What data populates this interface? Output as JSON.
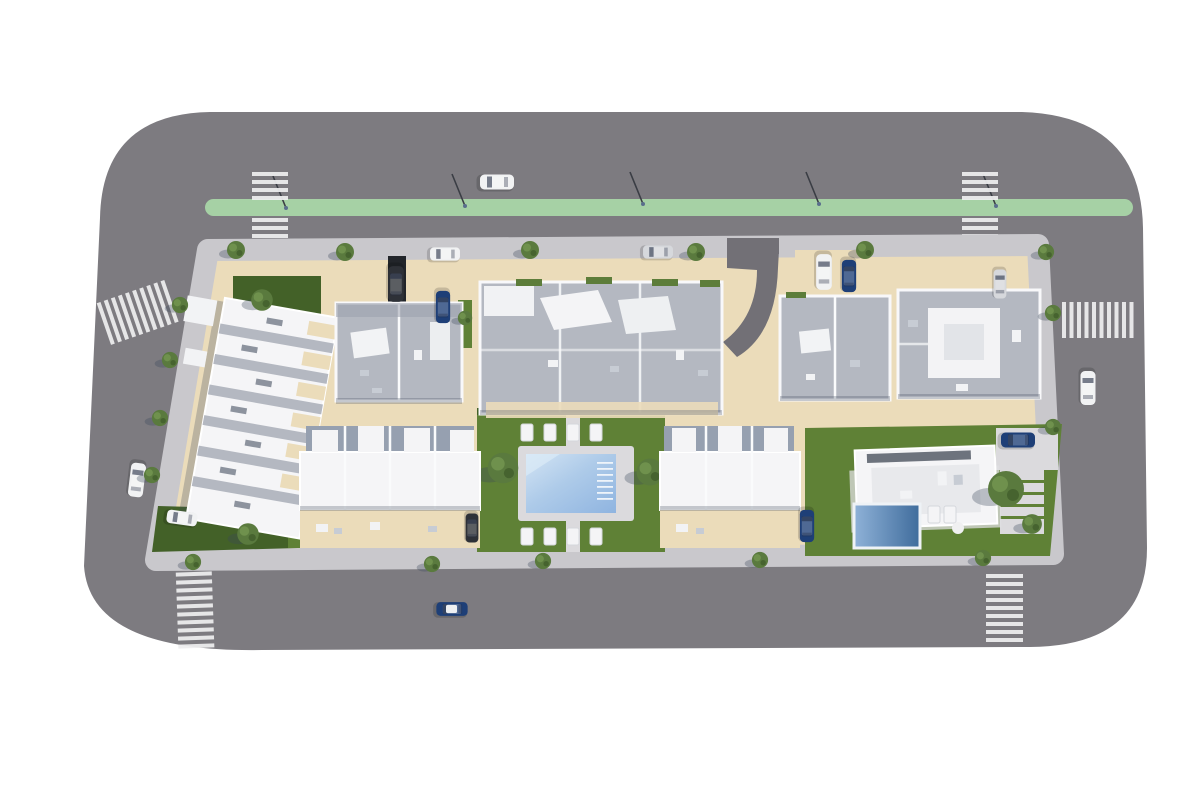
{
  "scene": {
    "kind": "aerial-architectural-render",
    "subject": "top-down 3D render of a residential development block surrounded by a perimeter road"
  },
  "colors": {
    "background": "#ffffff",
    "road": "#7d7b80",
    "roadDark": "#727076",
    "sidewalk": "#c9c8cc",
    "ground": "#ebdcba",
    "bikeLane": "#a6d1a5",
    "lawn": "#5f8136",
    "lawnDark": "#436128",
    "roofWhite": "#f5f5f7",
    "roofGray": "#b4b8c1",
    "roofGrayDark": "#9ba1ad",
    "court": "#96a0b0",
    "poolDeck": "#dbdadd",
    "poolWater": "#a9c9e8",
    "poolWaterLight": "#d3e4f4",
    "privatePoolDark": "#49739f",
    "crosswalk": "#eeeeef",
    "carWhite": "#f1f2f3",
    "carSilver": "#d6d8dc",
    "carBlue": "#1e3f77",
    "carDark": "#2e3137",
    "treeGreen": "#5a7a3e",
    "hedge": "#5d7d3a",
    "shadow": "rgba(66,75,94,0.28)"
  },
  "objects": {
    "roads": [
      "north-road",
      "east-road",
      "south-road",
      "west-road"
    ],
    "painted_lane": {
      "position": "north-road",
      "color_key": "bikeLane",
      "rounded_ends": true
    },
    "crosswalks": [
      "north-west",
      "north-east",
      "west",
      "east",
      "south-west",
      "south-east"
    ],
    "street_lamps": 5,
    "buildings": [
      {
        "id": "terraced-row-west",
        "style": "tilted row of stepped white-roof townhouses"
      },
      {
        "id": "apartment-block-north-1",
        "style": "gray roof terrace"
      },
      {
        "id": "apartment-block-north-2",
        "style": "large gray roof terrace with hedges"
      },
      {
        "id": "apartment-block-north-3",
        "style": "gray roof terrace"
      },
      {
        "id": "apartment-block-north-4",
        "style": "gray roof terrace with white core"
      },
      {
        "id": "terraced-row-south-1",
        "style": "white roofs with gray courtyards"
      },
      {
        "id": "terraced-row-south-2",
        "style": "white roofs with gray courtyards"
      },
      {
        "id": "villa-southeast",
        "style": "modern flat-roof villa",
        "private_pool": true
      }
    ],
    "communal_garden": {
      "pool": "rectangular with corner steps",
      "sun_loungers": 8,
      "trees": 2,
      "paths": true
    },
    "cars": [
      {
        "color": "white",
        "location": "north-road-travel-lane"
      },
      {
        "color": "white",
        "location": "north-road-parking-lane"
      },
      {
        "color": "silver",
        "location": "north-road-parking-lane"
      },
      {
        "color": "dark-van",
        "location": "block-1-driveway"
      },
      {
        "color": "blue",
        "location": "block-1-driveway"
      },
      {
        "color": "white-van",
        "location": "block-3-driveway"
      },
      {
        "color": "dark-blue",
        "location": "block-3-driveway"
      },
      {
        "color": "silver",
        "location": "block-4-driveway"
      },
      {
        "color": "white",
        "location": "east-road"
      },
      {
        "color": "blue",
        "location": "villa-driveway"
      },
      {
        "color": "white",
        "location": "west-road"
      },
      {
        "color": "white",
        "location": "terraced-row-west-parking"
      },
      {
        "color": "dark-gray",
        "location": "south-row-1-parking"
      },
      {
        "color": "blue",
        "location": "south-row-2-parking"
      },
      {
        "color": "blue-white-roof",
        "location": "south-road"
      }
    ],
    "trees_count": 25
  }
}
